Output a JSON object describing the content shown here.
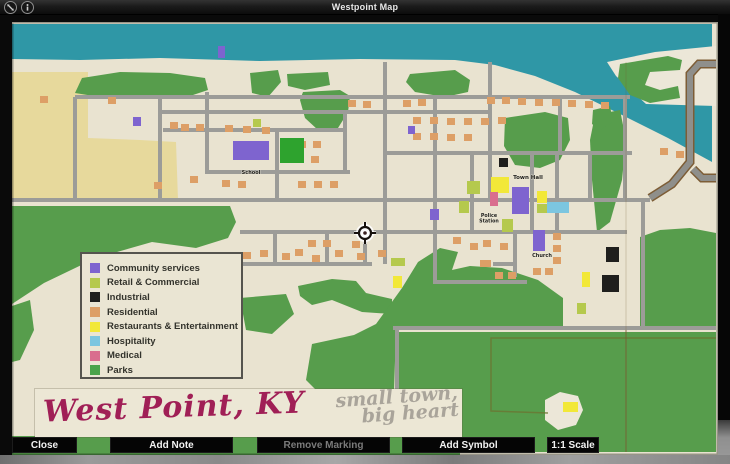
{
  "window": {
    "title": "Westpoint Map"
  },
  "icons": {
    "pin": "collapse-icon",
    "info": "info-icon"
  },
  "toolbar": {
    "close": "Close",
    "add_note": "Add Note",
    "remove_marking": "Remove Marking",
    "remove_marking_enabled": false,
    "add_symbol": "Add Symbol",
    "scale": "1:1 Scale"
  },
  "banner": {
    "title": "West Point, KY",
    "tagline_line1": "small town,",
    "tagline_line2": "big heart"
  },
  "legend": {
    "items": [
      {
        "label": "Community services",
        "color": "#7e64cf"
      },
      {
        "label": "Retail & Commercial",
        "color": "#b5c94d"
      },
      {
        "label": "Industrial",
        "color": "#1f1f1d"
      },
      {
        "label": "Residential",
        "color": "#dd9f66"
      },
      {
        "label": "Restaurants & Entertainment",
        "color": "#f2e838"
      },
      {
        "label": "Hospitality",
        "color": "#7cc6e0"
      },
      {
        "label": "Medical",
        "color": "#d96e8e"
      },
      {
        "label": "Parks",
        "color": "#4aa34a"
      }
    ]
  },
  "map": {
    "colors": {
      "paper": "#e9e3d0",
      "paper_far": "#ece7d8",
      "river": "#2f97a6",
      "sand_yellow": "#e7d99c",
      "park": "#579d4c",
      "park_bright": "#2ea32e",
      "road": "#9c9c98",
      "highway": "#8f8f8b",
      "highway_edge": "#7d5d36",
      "fold": "#7a5a30",
      "field_line": "#6b7532",
      "residential": "#dd9f66",
      "community": "#7e64cf",
      "retail": "#b5c94d",
      "industrial": "#1f1f1d",
      "restaurants": "#f2e838",
      "hospitality": "#7cc6e0",
      "medical": "#d96e8e"
    },
    "terrain": {
      "river": "12,24 712,24 712,162 668,138 620,114 575,92 535,76 495,65 455,60 360,59 260,61 160,58 80,60 12,59",
      "far_bank": "607,62 655,52 716,46 716,106 646,104 616,76",
      "sand_yellow": "12,72 88,72 88,138 140,140 176,142 178,200 12,200",
      "cream_blob": "545,400 560,392 578,396 583,410 576,425 558,430 545,420",
      "greens": [
        "75,93 82,78 120,72 170,73 205,78 208,90 190,96 140,97 100,97",
        "250,73 278,70 281,82 268,97 252,93",
        "287,74 328,72 330,85 305,90 288,86",
        "303,92 340,90 350,96 348,112 338,128 318,130 305,118 300,100",
        "410,74 455,70 470,80 468,92 445,97 415,92 406,82",
        "505,118 545,112 568,118 570,140 560,160 540,168 515,165 504,146",
        "595,115 620,110 626,140 622,180 610,222 597,232 592,180 590,140",
        "620,64 668,56 682,60 680,70 650,72 645,85 660,90 678,86 680,98 650,103 630,95 618,78",
        "593,110 610,106 613,122 600,130 592,124",
        "12,206 230,206 236,222 228,238 196,248 152,242 96,258 44,283 12,304",
        "12,306 30,300 34,330 20,360 12,362",
        "298,286 332,279 356,281 366,293 392,299 392,314 362,312 332,300 312,305 300,296",
        "240,298 286,294 294,314 272,334 246,330",
        "306,380 312,344 354,335 376,324 402,288 418,262 440,248 458,252 452,270 470,266 502,268 538,280 563,298 563,330 396,330 394,392 318,392",
        "640,237 660,230 690,228 716,233 716,328 640,328",
        "395,332 716,332 716,452 395,452",
        "12,436 460,436 460,455 12,455"
      ]
    },
    "roads": [
      [
        75,
        97,
        630,
        97
      ],
      [
        160,
        112,
        490,
        112
      ],
      [
        163,
        130,
        345,
        130
      ],
      [
        207,
        172,
        350,
        172
      ],
      [
        385,
        153,
        632,
        153
      ],
      [
        12,
        200,
        650,
        200
      ],
      [
        240,
        232,
        627,
        232
      ],
      [
        240,
        264,
        372,
        264
      ],
      [
        435,
        282,
        527,
        282
      ],
      [
        493,
        264,
        517,
        264
      ],
      [
        393,
        328,
        716,
        328
      ],
      [
        75,
        97,
        75,
        200
      ],
      [
        160,
        97,
        160,
        200
      ],
      [
        207,
        92,
        207,
        174
      ],
      [
        277,
        130,
        277,
        200
      ],
      [
        345,
        112,
        345,
        174
      ],
      [
        385,
        62,
        385,
        264
      ],
      [
        435,
        97,
        435,
        284
      ],
      [
        490,
        62,
        490,
        200
      ],
      [
        472,
        153,
        472,
        234
      ],
      [
        532,
        153,
        532,
        234
      ],
      [
        557,
        153,
        557,
        234
      ],
      [
        590,
        153,
        590,
        202
      ],
      [
        625,
        97,
        625,
        200
      ],
      [
        643,
        200,
        643,
        330
      ],
      [
        560,
        97,
        560,
        155
      ],
      [
        515,
        232,
        515,
        277
      ],
      [
        327,
        232,
        327,
        266
      ],
      [
        275,
        232,
        275,
        266
      ],
      [
        365,
        232,
        365,
        266
      ],
      [
        397,
        328,
        397,
        392
      ]
    ],
    "highway": [
      "M716,64 L699,64 L690,74 L690,162 L672,184 L650,198",
      "M716,178 L702,178 L693,169"
    ],
    "field_line": "M716,338 L491,338 L491,411 L548,413",
    "fold_x": 626,
    "residential_size": [
      8,
      7
    ],
    "residential": [
      [
        40,
        96
      ],
      [
        108,
        97
      ],
      [
        170,
        122
      ],
      [
        181,
        124
      ],
      [
        196,
        124
      ],
      [
        225,
        125
      ],
      [
        243,
        126
      ],
      [
        262,
        127
      ],
      [
        348,
        100
      ],
      [
        363,
        101
      ],
      [
        403,
        100
      ],
      [
        418,
        99
      ],
      [
        413,
        117
      ],
      [
        430,
        117
      ],
      [
        447,
        118
      ],
      [
        464,
        118
      ],
      [
        481,
        118
      ],
      [
        498,
        117
      ],
      [
        413,
        133
      ],
      [
        430,
        133
      ],
      [
        447,
        134
      ],
      [
        464,
        134
      ],
      [
        487,
        97
      ],
      [
        502,
        97
      ],
      [
        518,
        98
      ],
      [
        535,
        99
      ],
      [
        552,
        99
      ],
      [
        568,
        100
      ],
      [
        585,
        101
      ],
      [
        601,
        102
      ],
      [
        298,
        141
      ],
      [
        313,
        141
      ],
      [
        296,
        156
      ],
      [
        311,
        156
      ],
      [
        154,
        182
      ],
      [
        190,
        176
      ],
      [
        222,
        180
      ],
      [
        238,
        181
      ],
      [
        298,
        181
      ],
      [
        314,
        181
      ],
      [
        330,
        181
      ],
      [
        243,
        252
      ],
      [
        260,
        250
      ],
      [
        282,
        253
      ],
      [
        295,
        249
      ],
      [
        312,
        255
      ],
      [
        335,
        250
      ],
      [
        357,
        253
      ],
      [
        378,
        250
      ],
      [
        308,
        240
      ],
      [
        323,
        240
      ],
      [
        352,
        241
      ],
      [
        453,
        237
      ],
      [
        470,
        243
      ],
      [
        480,
        260
      ],
      [
        483,
        240
      ],
      [
        500,
        243
      ],
      [
        483,
        260
      ],
      [
        495,
        272
      ],
      [
        508,
        272
      ],
      [
        533,
        268
      ],
      [
        545,
        268
      ],
      [
        553,
        233
      ],
      [
        553,
        245
      ],
      [
        553,
        257
      ],
      [
        660,
        148
      ],
      [
        676,
        151
      ]
    ],
    "special_buildings": [
      [
        233,
        141,
        36,
        19,
        "community"
      ],
      [
        512,
        187,
        17,
        27,
        "community"
      ],
      [
        533,
        230,
        12,
        21,
        "community"
      ],
      [
        133,
        117,
        8,
        9,
        "community"
      ],
      [
        430,
        209,
        9,
        11,
        "community"
      ],
      [
        218,
        46,
        7,
        12,
        "community"
      ],
      [
        408,
        126,
        7,
        8,
        "community"
      ],
      [
        499,
        158,
        9,
        9,
        "industrial"
      ],
      [
        606,
        247,
        13,
        15,
        "industrial"
      ],
      [
        602,
        275,
        17,
        17,
        "industrial"
      ],
      [
        491,
        177,
        18,
        16,
        "restaurants"
      ],
      [
        537,
        191,
        10,
        12,
        "restaurants"
      ],
      [
        393,
        276,
        9,
        12,
        "restaurants"
      ],
      [
        582,
        272,
        8,
        15,
        "restaurants"
      ],
      [
        563,
        402,
        15,
        10,
        "restaurants"
      ],
      [
        467,
        181,
        13,
        13,
        "retail"
      ],
      [
        459,
        201,
        10,
        12,
        "retail"
      ],
      [
        537,
        204,
        10,
        9,
        "retail"
      ],
      [
        502,
        219,
        11,
        13,
        "retail"
      ],
      [
        391,
        258,
        14,
        8,
        "retail"
      ],
      [
        253,
        119,
        8,
        8,
        "retail"
      ],
      [
        577,
        303,
        9,
        11,
        "retail"
      ],
      [
        547,
        202,
        22,
        11,
        "hospitality"
      ],
      [
        490,
        192,
        8,
        14,
        "medical"
      ],
      [
        280,
        138,
        24,
        25,
        "parkfield"
      ]
    ],
    "labels": [
      {
        "name": "map-label-school",
        "x": 251,
        "y": 174,
        "size": 5,
        "lines": [
          "School"
        ]
      },
      {
        "name": "map-label-town-hall",
        "x": 528,
        "y": 179,
        "size": 5.5,
        "lines": [
          "Town Hall"
        ]
      },
      {
        "name": "map-label-police-station",
        "x": 489,
        "y": 217,
        "size": 4.8,
        "lines": [
          "Police",
          "Station"
        ]
      },
      {
        "name": "map-label-church",
        "x": 542,
        "y": 257,
        "size": 5,
        "lines": [
          "Church"
        ]
      }
    ],
    "player_marker": {
      "x": 365,
      "y": 233
    }
  }
}
